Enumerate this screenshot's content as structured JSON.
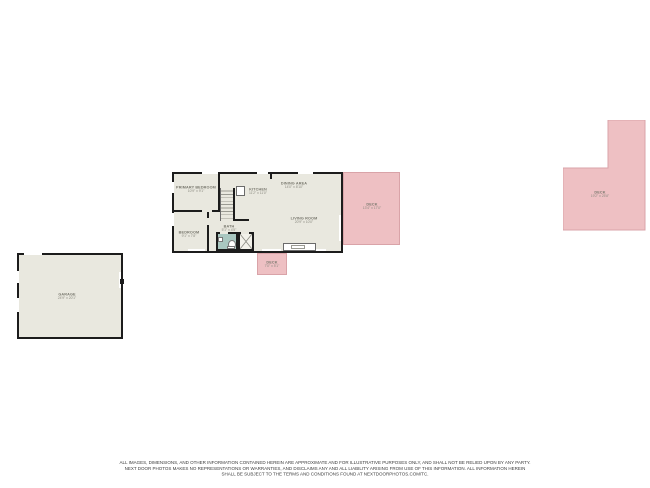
{
  "document": {
    "type": "residential-floor-plan",
    "background_color": "#ffffff"
  },
  "colors": {
    "wall": "#1c1c1c",
    "floor": "#e9e8df",
    "deck_fill": "#eec0c3",
    "deck_border": "#d9a3a8",
    "bath_floor": "#a9c7c0",
    "label_text": "#78776d",
    "disclaimer_text": "#3c3c3c"
  },
  "rooms": [
    {
      "id": "primary-bedroom",
      "name": "PRIMARY BEDROOM",
      "dims": "10'9\" x 9'1\"",
      "x": 196,
      "y": 189
    },
    {
      "id": "kitchen",
      "name": "KITCHEN",
      "dims": "11'2\" x 11'0\"",
      "x": 258,
      "y": 191
    },
    {
      "id": "dining-area",
      "name": "DINING AREA",
      "dims": "14'0\" x 8'10\"",
      "x": 294,
      "y": 185
    },
    {
      "id": "living-room",
      "name": "LIVING ROOM",
      "dims": "20'9\" x 10'0\"",
      "x": 304,
      "y": 220
    },
    {
      "id": "bedroom",
      "name": "BEDROOM",
      "dims": "9'1\" x 7'8\"",
      "x": 189,
      "y": 234
    },
    {
      "id": "bath",
      "name": "BATH",
      "dims": "5'1\" x 4'5\"",
      "x": 229,
      "y": 228
    },
    {
      "id": "side-deck",
      "name": "DECK",
      "dims": "13'4\" x 17'0\"",
      "x": 372,
      "y": 206
    },
    {
      "id": "porch-deck",
      "name": "DECK",
      "dims": "7'0\" x 5'1\"",
      "x": 272,
      "y": 264
    },
    {
      "id": "rear-deck",
      "name": "DECK",
      "dims": "19'2\" x 25'8\"",
      "x": 600,
      "y": 194
    },
    {
      "id": "garage",
      "name": "GARAGE",
      "dims": "24'9\" x 20'1\"",
      "x": 67,
      "y": 296
    }
  ],
  "fixtures": [
    {
      "icon": "staircase-icon"
    },
    {
      "icon": "toilet-icon"
    },
    {
      "icon": "sink-icon"
    },
    {
      "icon": "closet-cross-icon"
    },
    {
      "icon": "kitchen-counter-icon"
    },
    {
      "icon": "appliance-icon"
    }
  ],
  "disclaimer": {
    "line1": "ALL IMAGES, DIMENSIONS, AND OTHER INFORMATION CONTAINED HEREIN ARE APPROXIMATE AND FOR ILLUSTRATIVE PURPOSES ONLY, AND SHALL NOT BE RELIED UPON BY ANY PARTY.",
    "line2": "NEXT DOOR PHOTOS MAKES NO REPRESENTATIONS OR WARRANTIES, AND DISCLAIMS ANY AND ALL LIABILITY ARISING FROM USE OF THIS INFORMATION. ALL INFORMATION HEREIN",
    "line3": "SHALL BE SUBJECT TO THE TERMS AND CONDITIONS FOUND AT NEXTDOORPHOTOS.COM/TC."
  }
}
